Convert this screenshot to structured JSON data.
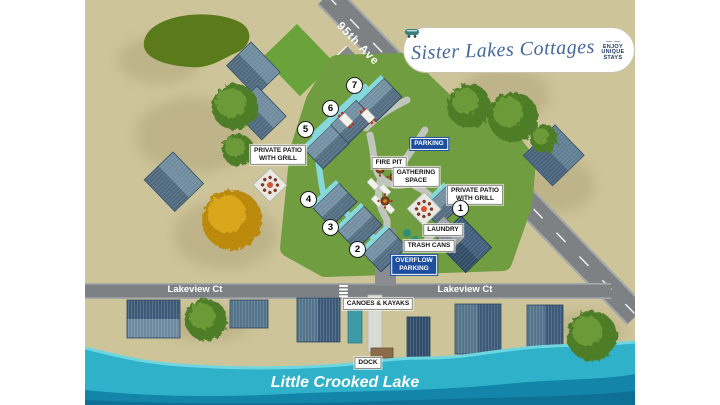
{
  "logo": {
    "title": "Sister Lakes Cottages",
    "badge": {
      "l1": "ENJOY",
      "l2": "UNIQUE",
      "l3": "STAYS",
      "dash": "—"
    }
  },
  "roads": {
    "ave": "95th Ave",
    "lakeview_left": "Lakeview Ct",
    "lakeview_right": "Lakeview Ct"
  },
  "lake": {
    "name": "Little Crooked Lake"
  },
  "labels": {
    "parking": "PARKING",
    "overflow": {
      "l1": "OVERFLOW",
      "l2": "PARKING"
    },
    "fire_pit": "FIRE PIT",
    "gathering": {
      "l1": "GATHERING",
      "l2": "SPACE"
    },
    "patio_left": {
      "l1": "PRIVATE PATIO",
      "l2": "WITH GRILL"
    },
    "patio_right": {
      "l1": "PRIVATE PATIO",
      "l2": "WITH GRILL"
    },
    "laundry": "LAUNDRY",
    "trash": "TRASH CANS",
    "canoes": "CANOES & KAYAKS",
    "dock": "DOCK"
  },
  "cottages": [
    {
      "number": "1"
    },
    {
      "number": "2"
    },
    {
      "number": "3"
    },
    {
      "number": "4"
    },
    {
      "number": "5"
    },
    {
      "number": "6"
    },
    {
      "number": "7"
    }
  ],
  "colors": {
    "sand": "#cec49a",
    "lawn": "#6f9d40",
    "road": "#7e8184",
    "lake": "#2fb2c9",
    "lake_dark": "#1285a8",
    "label_blue": "#1d4f9e",
    "roof_light": "#6e8a9d",
    "roof_dark": "#4d687d",
    "teal_walk": "#86d8db",
    "logo_blue": "#44679e"
  }
}
